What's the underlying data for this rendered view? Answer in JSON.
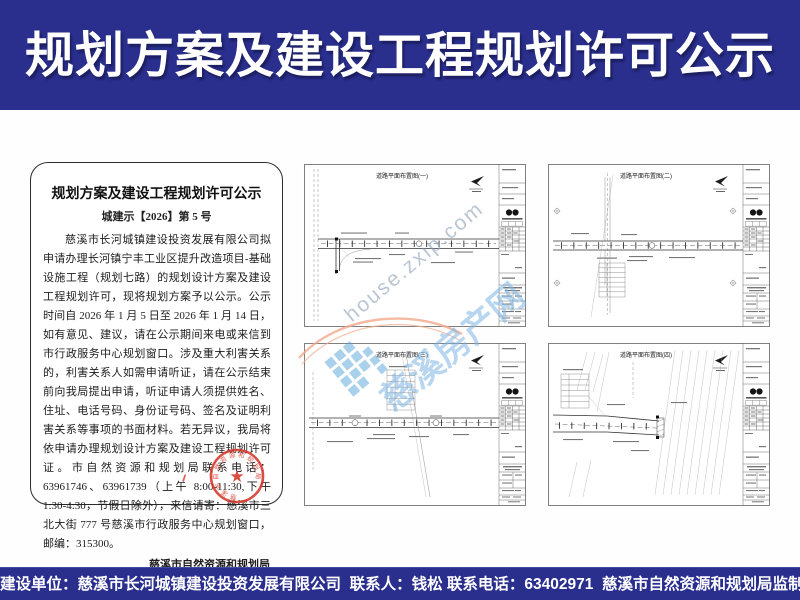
{
  "header": {
    "title": "规划方案及建设工程规划许可公示"
  },
  "notice": {
    "title": "规划方案及建设工程规划许可公示",
    "doc_number": "城建示【2026】第 5 号",
    "body": "慈溪市长河城镇建设投资发展有限公司拟申请办理长河镇宁丰工业区提升改造项目-基础设施工程（规划七路）的规划设计方案及建设工程规划许可，现将规划方案予以公示。公示时间自 2026 年 1 月 5 日至 2026 年 1 月 14 日，如有意见、建议，请在公示期间来电或来信到市行政服务中心规划窗口。涉及重大利害关系的，利害关系人如需申请听证，请在公示结束前向我局提出申请，听证申请人须提供姓名、住址、电话号码、身份证号码、签名及证明利害关系等事项的书面材料。若无异议，我局将依申请办理规划设计方案及建设工程规划许可证。市自然资源和规划局联系电话：63961746、63961739（上午 8:00-11:30,下午 1:30-4:30，节假日除外），来信请寄：慈溪市三北大街 777 号慈溪市行政服务中心规划窗口，邮编：315300。",
    "signature": "慈溪市自然资源和规划局",
    "date": "二〇二六年一月五日",
    "seal_text": "慈溪市自然资源和规划局"
  },
  "drawings": {
    "panels": [
      {
        "title": "道路平面布置图(一)"
      },
      {
        "title": "道路平面布置图(二)"
      },
      {
        "title": "道路平面布置图(三)"
      },
      {
        "title": "道路平面布置图(四)"
      }
    ]
  },
  "watermark": {
    "url_text": "house.zxip.com",
    "site_text": "慈溪房产网"
  },
  "footer": {
    "text": "建设单位：慈溪市长河城镇建设投资发展有限公司  联系人：钱松 联系电话：63402971  慈溪市自然资源和规划局监制   2026年1月5日"
  },
  "colors": {
    "banner_navy": "#2a2f8d",
    "seal_red": "#d63c2f",
    "watermark_blue": "#7db4e1",
    "watermark_orange": "#f2a98c"
  }
}
